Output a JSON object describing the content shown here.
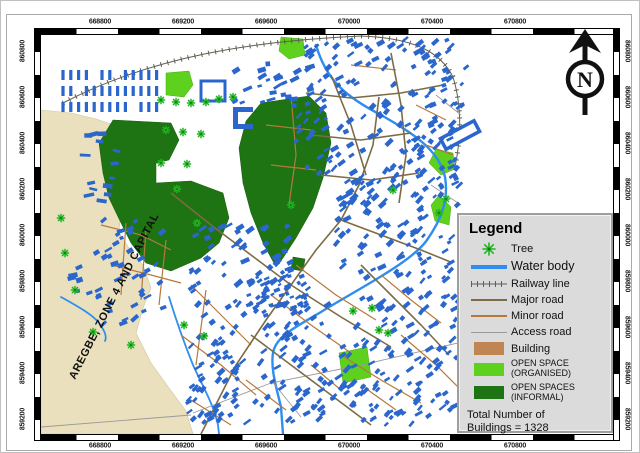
{
  "map": {
    "region_label": "AREGBE, ZONE 4 AND CAPITAL",
    "north_label": "N",
    "colors": {
      "building": "#2a66cc",
      "water": "#2e8ef0",
      "beige_zone": "#eae0bd",
      "open_organised": "#5ed01e",
      "open_informal": "#1e7312",
      "road_major": "#7d6b45",
      "road_minor": "#b5793c",
      "road_access": "#9a9a9a",
      "railway": "#5f5f55",
      "tree": "#1fb522"
    },
    "building_clusters": [
      {
        "grid": true,
        "x": 22,
        "y": 40,
        "cols": 13,
        "rows": 3,
        "dx": 7.8,
        "dy": 16,
        "bw": 3.2,
        "bh": 10,
        "rot": 0
      },
      {
        "x": 40,
        "y": 96,
        "w": 38,
        "h": 78,
        "count": 14,
        "bw": 7,
        "bh": 3.2,
        "rot": 0
      },
      {
        "x": 185,
        "y": 24,
        "w": 85,
        "h": 48,
        "count": 26,
        "bw": 6,
        "bh": 3.4,
        "rot": -20
      },
      {
        "x": 262,
        "y": 4,
        "w": 150,
        "h": 62,
        "count": 68,
        "bw": 5.6,
        "bh": 3.2,
        "rot": -40
      },
      {
        "x": 300,
        "y": 66,
        "w": 122,
        "h": 112,
        "count": 115,
        "bw": 5.6,
        "bh": 3.2,
        "rot": -40
      },
      {
        "x": 255,
        "y": 70,
        "w": 45,
        "h": 68,
        "count": 24,
        "bw": 5.4,
        "bh": 3,
        "rot": -40
      },
      {
        "x": 385,
        "y": 22,
        "w": 42,
        "h": 78,
        "count": 20,
        "bw": 5,
        "bh": 3,
        "rot": -30
      },
      {
        "x": 150,
        "y": 188,
        "w": 100,
        "h": 72,
        "count": 50,
        "bw": 6,
        "bh": 3.4,
        "rot": -35
      },
      {
        "x": 205,
        "y": 233,
        "w": 62,
        "h": 46,
        "count": 62,
        "bw": 4.4,
        "bh": 2.6,
        "rot": -30
      },
      {
        "x": 155,
        "y": 266,
        "w": 160,
        "h": 122,
        "count": 105,
        "bw": 5.6,
        "bh": 3.2,
        "rot": -40
      },
      {
        "x": 312,
        "y": 238,
        "w": 108,
        "h": 148,
        "count": 92,
        "bw": 5.6,
        "bh": 3.2,
        "rot": -40
      },
      {
        "x": 290,
        "y": 162,
        "w": 95,
        "h": 75,
        "count": 42,
        "bw": 5.6,
        "bh": 3.2,
        "rot": -40
      },
      {
        "x": 55,
        "y": 185,
        "w": 68,
        "h": 108,
        "count": 38,
        "bw": 5.6,
        "bh": 3.2,
        "rot": -30
      },
      {
        "x": 145,
        "y": 298,
        "w": 55,
        "h": 88,
        "count": 34,
        "bw": 5,
        "bh": 3,
        "rot": -40
      },
      {
        "x": 30,
        "y": 226,
        "w": 28,
        "h": 42,
        "count": 8,
        "bw": 6,
        "bh": 3.4,
        "rot": -15
      },
      {
        "x": 370,
        "y": 195,
        "w": 44,
        "h": 68,
        "count": 22,
        "bw": 5,
        "bh": 3,
        "rot": -35
      },
      {
        "x": 255,
        "y": 344,
        "w": 130,
        "h": 46,
        "count": 38,
        "bw": 5.4,
        "bh": 3,
        "rot": -40
      }
    ],
    "trees": [
      [
        120,
        65
      ],
      [
        135,
        67
      ],
      [
        150,
        68
      ],
      [
        165,
        67
      ],
      [
        178,
        64
      ],
      [
        192,
        62
      ],
      [
        125,
        95
      ],
      [
        142,
        97
      ],
      [
        160,
        99
      ],
      [
        120,
        128
      ],
      [
        146,
        129
      ],
      [
        136,
        154
      ],
      [
        156,
        188
      ],
      [
        250,
        170
      ],
      [
        20,
        183
      ],
      [
        24,
        218
      ],
      [
        34,
        255
      ],
      [
        52,
        297
      ],
      [
        90,
        310
      ],
      [
        143,
        290
      ],
      [
        163,
        301
      ],
      [
        312,
        276
      ],
      [
        331,
        273
      ],
      [
        338,
        295
      ],
      [
        347,
        298
      ],
      [
        405,
        164
      ],
      [
        398,
        178
      ],
      [
        352,
        155
      ]
    ]
  },
  "axes": {
    "top": [
      "668800",
      "669200",
      "669600",
      "670000",
      "670400",
      "670800"
    ],
    "bottom": [
      "668800",
      "669200",
      "669600",
      "670000",
      "670400",
      "670800"
    ],
    "left": [
      "860800",
      "860600",
      "860400",
      "860200",
      "860000",
      "859800",
      "859600",
      "859400",
      "859200"
    ],
    "right": [
      "860800",
      "860600",
      "860400",
      "860200",
      "860000",
      "859800",
      "859600",
      "859400",
      "859200"
    ]
  },
  "legend": {
    "title": "Legend",
    "items": [
      {
        "label": "Tree",
        "type": "tree"
      },
      {
        "label": "Water body",
        "type": "line",
        "color": "#2e8ef0",
        "weight": 4,
        "big": true
      },
      {
        "label": "Railway line",
        "type": "railway",
        "color": "#5f5f55"
      },
      {
        "label": "Major road",
        "type": "line",
        "color": "#7d6b45",
        "weight": 2
      },
      {
        "label": "Minor road",
        "type": "line",
        "color": "#b5793c",
        "weight": 2
      },
      {
        "label": "Access road",
        "type": "line",
        "color": "#9a9a9a",
        "weight": 1
      },
      {
        "label": "Building",
        "type": "fill",
        "color": "#c08552"
      },
      {
        "label": "OPEN SPACE (ORGANISED)",
        "type": "fill",
        "color": "#5ed01e",
        "small": true
      },
      {
        "label": "OPEN SPACES (INFORMAL)",
        "type": "fill",
        "color": "#1e7312",
        "small": true
      }
    ],
    "total_note": [
      "Total Number of",
      "Buildings = 1328"
    ]
  }
}
